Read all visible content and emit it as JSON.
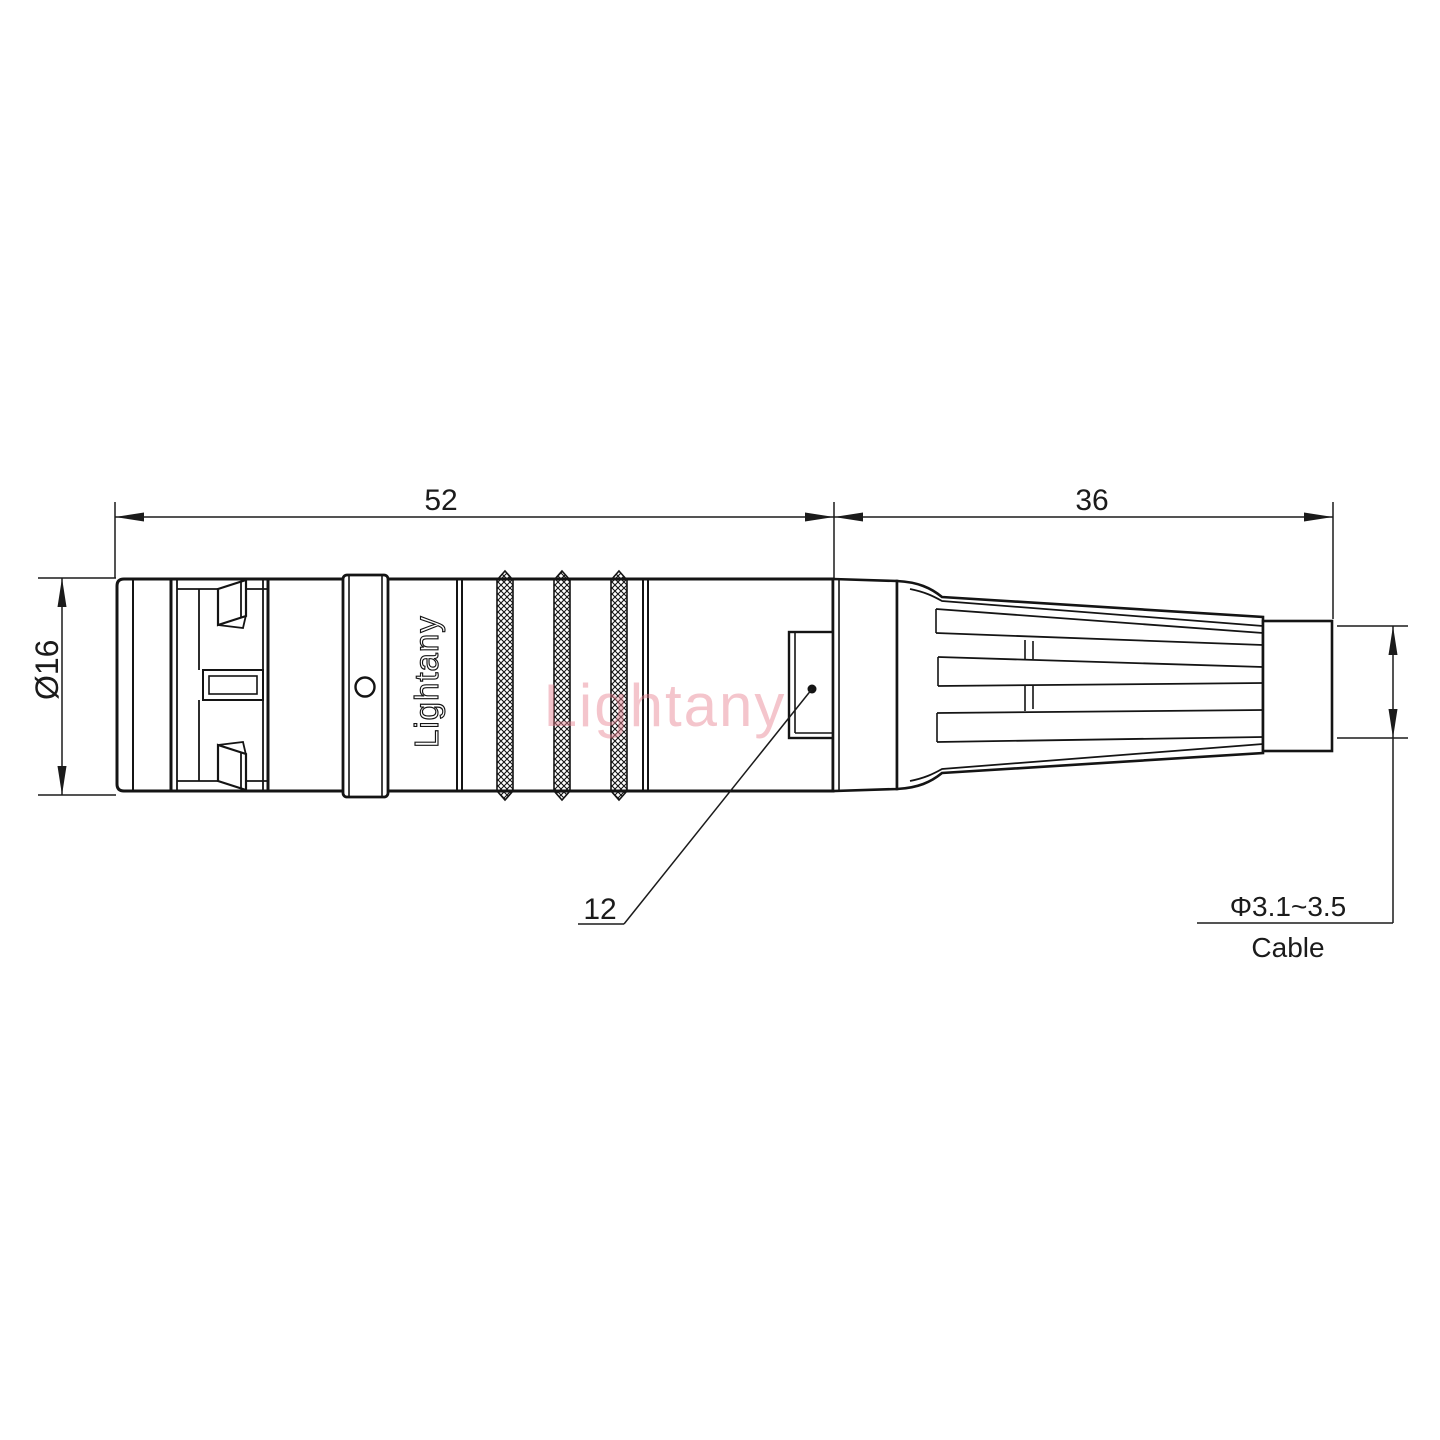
{
  "drawing": {
    "type": "connector-engineering-drawing",
    "dims": {
      "front_length": "52",
      "back_length": "36",
      "diameter": "Ø16",
      "window_size": "12",
      "cable_range": "Φ3.1~3.5",
      "cable_label": "Cable"
    },
    "branding": {
      "engraving": "Lightany",
      "watermark": "Lightany"
    },
    "colors": {
      "line": "#1b1b1b",
      "watermark": "#e8808f"
    }
  }
}
